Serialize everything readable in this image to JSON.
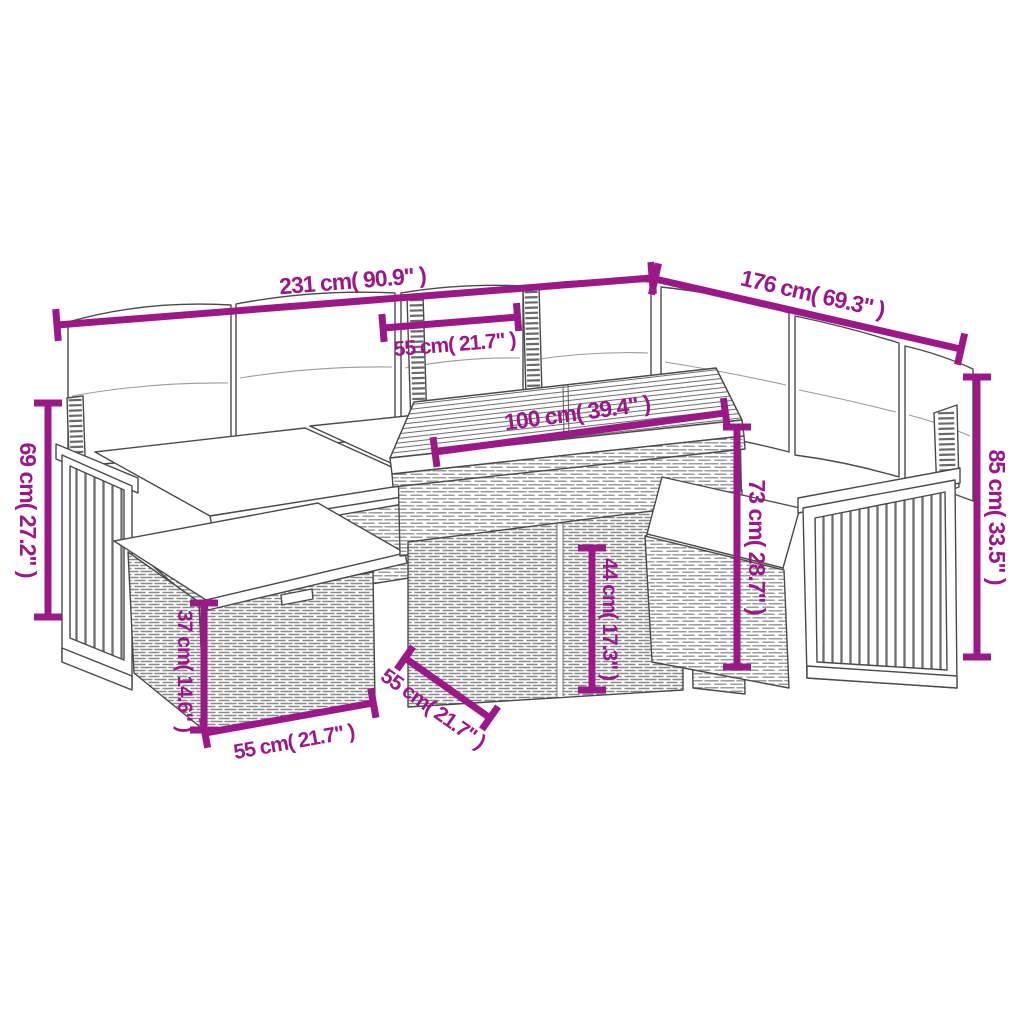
{
  "diagram": {
    "kind": "product-dimension-line-drawing",
    "subject": "rattan-corner-sofa-set-with-table-and-footstools",
    "accent_color": "#9B1889",
    "line_color": "#4a4a4a",
    "labels": {
      "overall_width": "231 cm( 90.9\" )",
      "overall_depth": "176 cm( 69.3\" )",
      "seat_width": "55 cm( 21.7\" )",
      "table_length": "100 cm( 39.4\" )",
      "left_back_height": "69 cm( 27.2\" )",
      "right_back_height": "85 cm( 33.5\" )",
      "table_height": "73 cm( 28.7\" )",
      "stool_height": "44 cm( 17.3\" )",
      "ottoman_height": "37 cm( 14.6\" )",
      "ottoman_width": "55 cm( 21.7\" )",
      "table_depth": "55 cm( 21.7\" )"
    }
  }
}
